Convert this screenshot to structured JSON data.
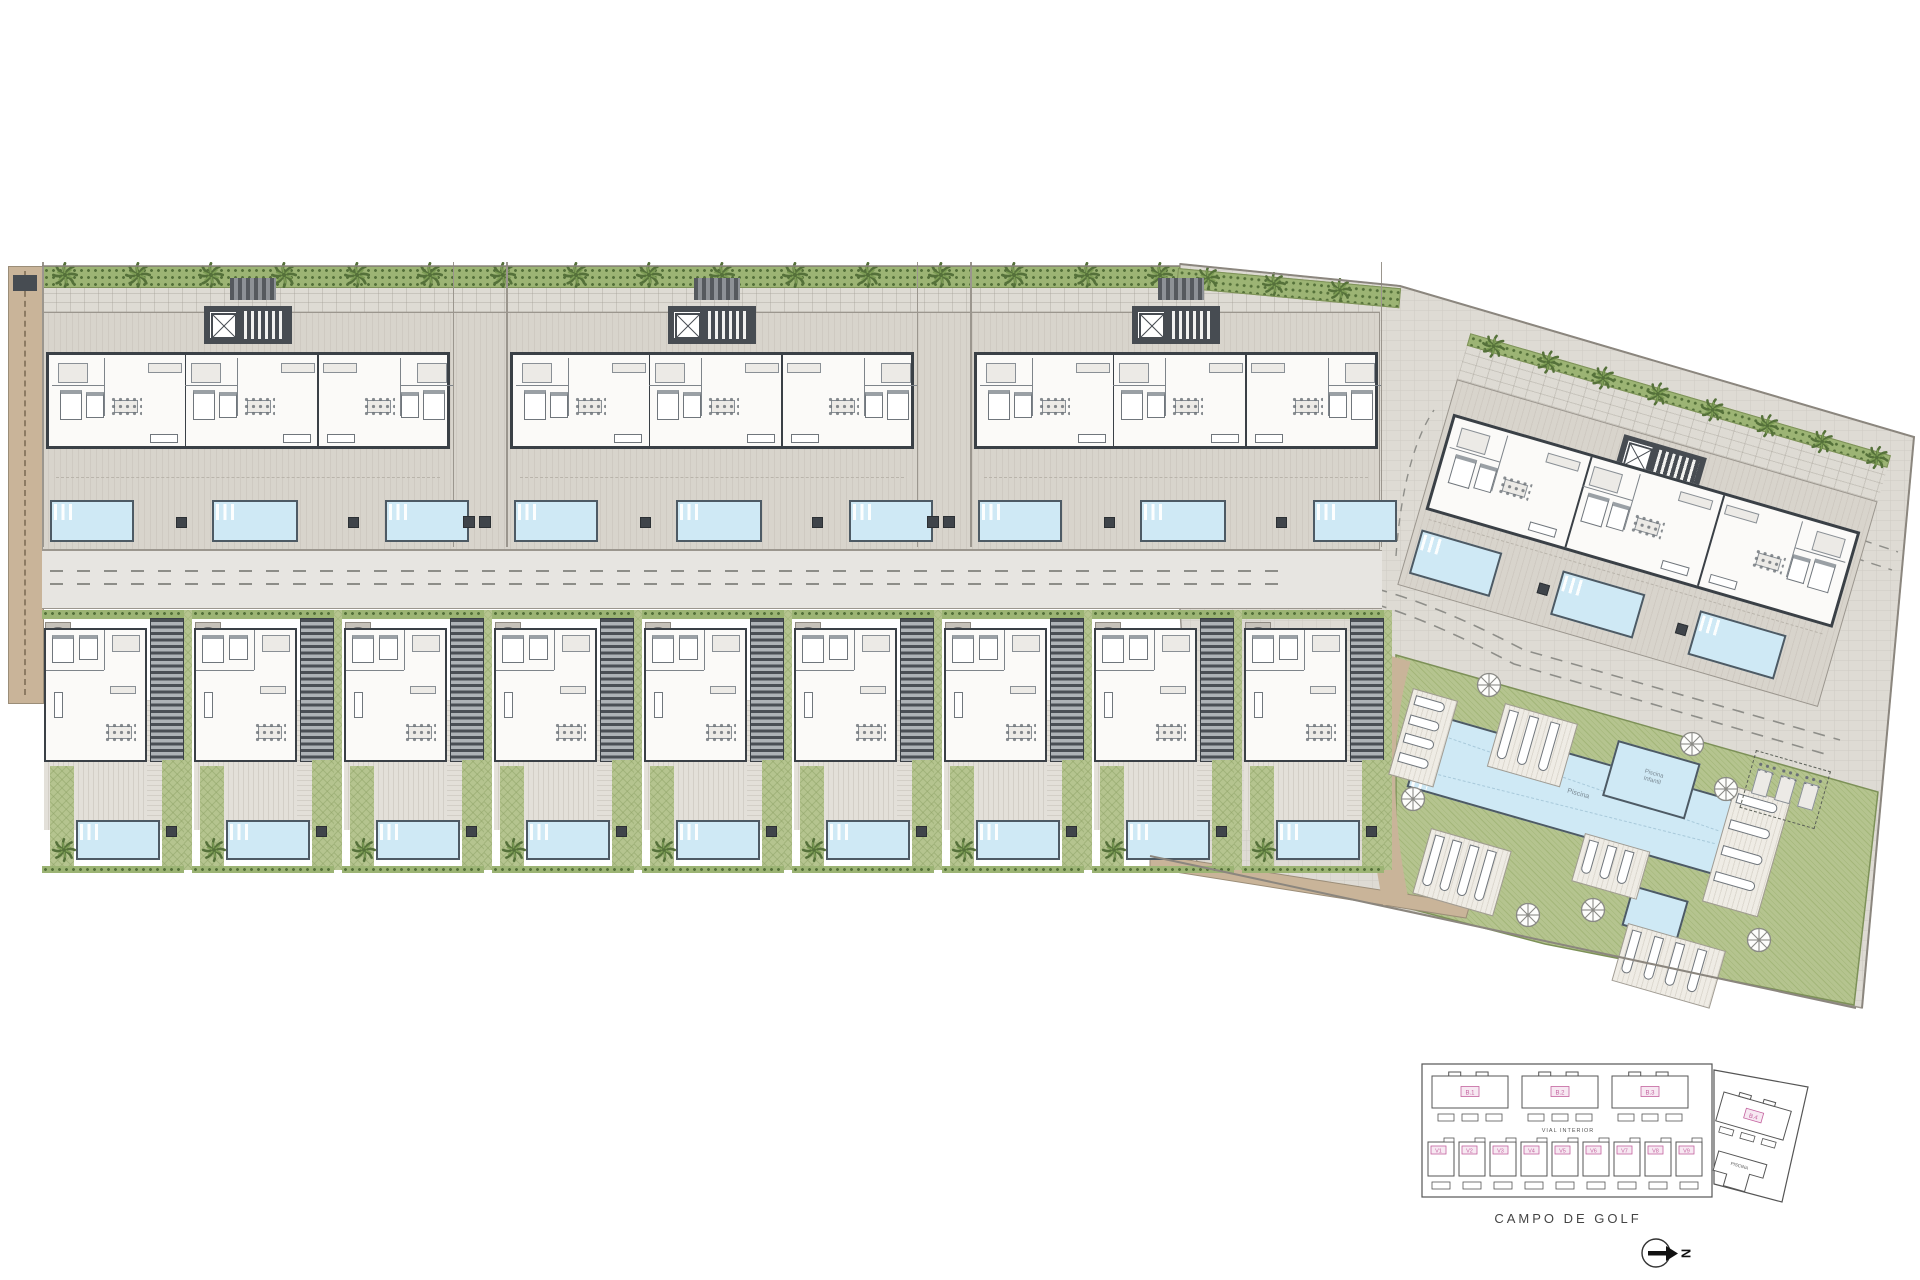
{
  "plan": {
    "buildings": [
      {
        "id": "B.1"
      },
      {
        "id": "B.2"
      },
      {
        "id": "B.3"
      },
      {
        "id": "B.4"
      }
    ],
    "villas": [
      {
        "id": "V1"
      },
      {
        "id": "V2"
      },
      {
        "id": "V3"
      },
      {
        "id": "V4"
      },
      {
        "id": "V5"
      },
      {
        "id": "V6"
      },
      {
        "id": "V7"
      },
      {
        "id": "V8"
      },
      {
        "id": "V9"
      }
    ],
    "communal": {
      "main_pool_label": "Piscina",
      "kids_pool_label_line1": "Piscina",
      "kids_pool_label_line2": "Infantil"
    },
    "key_plan": {
      "road_label": "VIAL INTERIOR",
      "golf_label": "CAMPO DE GOLF",
      "pool_label": "PISCINA",
      "north_label": "N"
    },
    "icons": {
      "palm": "palm-tree-icon",
      "parasol": "parasol-icon",
      "north": "north-arrow-icon"
    },
    "colors": {
      "wall": "#3a4046",
      "water": "#cfe9f5",
      "water_border": "#4d5a64",
      "grass": "#b5c48f",
      "hedge": "#9cb474",
      "palm_dark": "#55713a",
      "palm_light": "#7c9c54",
      "terrace": "#d8d4cc",
      "paving": "#dedbd4",
      "road": "#e7e5e1",
      "sand": "#c9b499",
      "tag_pink": "#c4639f",
      "line": "#8b867e"
    }
  }
}
